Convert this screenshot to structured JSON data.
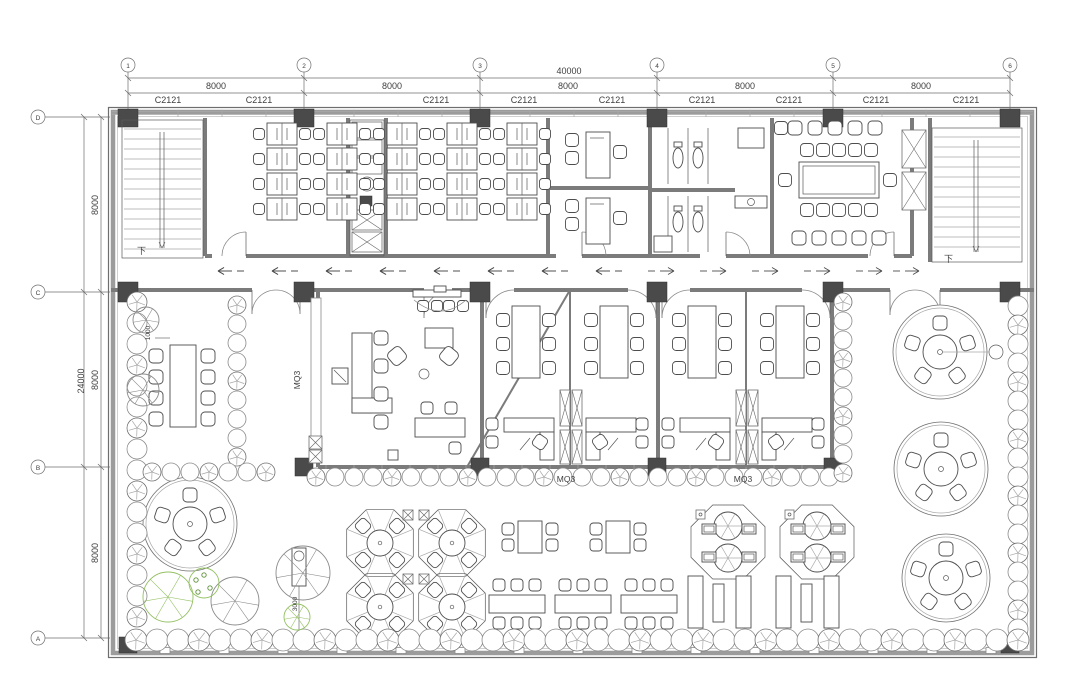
{
  "document": {
    "type": "architectural-floor-plan",
    "level": "office-floor"
  },
  "dimensions": {
    "top_total": "40000",
    "top_bays": [
      "8000",
      "8000",
      "8000",
      "8000",
      "8000"
    ],
    "left_total": "24000",
    "left_bays": [
      "8000",
      "8000",
      "8000"
    ],
    "left_offset": "1000",
    "bottom_offset": "3000"
  },
  "grid": {
    "top_labels": [
      "1",
      "2",
      "3",
      "4",
      "5",
      "6"
    ],
    "left_labels": [
      "D",
      "C",
      "B",
      "A"
    ]
  },
  "window_tags": [
    "C2121",
    "C2121",
    "C2121",
    "C2121",
    "C2121",
    "C2121",
    "C2121",
    "C2121",
    "C2121"
  ],
  "curtain_wall_tags": [
    "MQ3",
    "MQ3",
    "MQ3"
  ],
  "stair_labels": {
    "left": "下",
    "right": "下"
  },
  "colors": {
    "line": "#4d4d4d",
    "wall": "#7b7b7b",
    "column": "#4a4a4a",
    "shrub": "#8b8b8b",
    "tree_green": "#94c063",
    "tree_green_dark": "#5f9038",
    "dim_text": "#3f3f3f"
  }
}
